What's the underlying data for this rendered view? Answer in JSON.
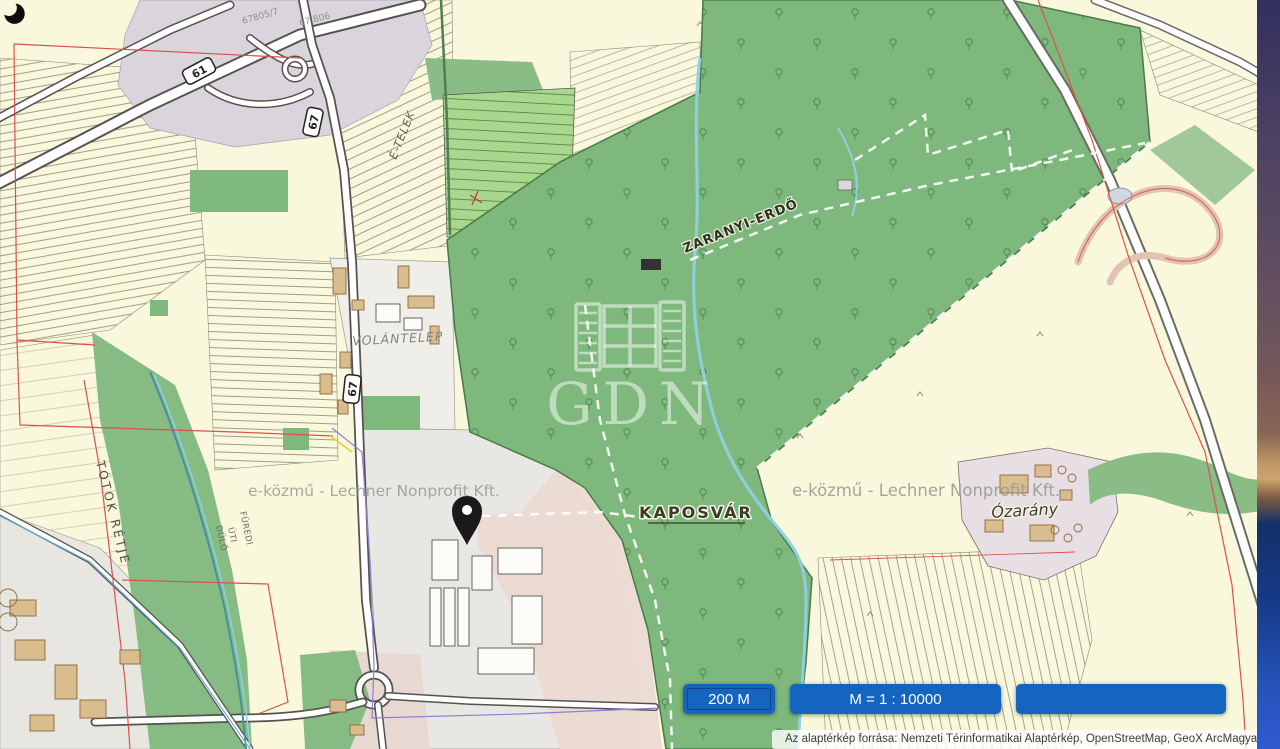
{
  "map": {
    "labels": {
      "city": "KAPOSVÁR",
      "forest": "ZARANYI-ERDŐ",
      "volantelep": "VOLÁNTELEP",
      "etelek": "É-TELEK",
      "totok_retje": "TÓTOK RÉTJE",
      "furedi": [
        "FÜREDI",
        "ÚTI",
        "DŰLŐ"
      ],
      "ozarany": "Ózarány"
    },
    "road_shields": {
      "s61": "61",
      "s67": "67"
    },
    "road_refs": {
      "ref1": "67805/7",
      "ref2": "67 806"
    },
    "watermarks": {
      "logo_text": "GDN",
      "provider": "e-közmű - Lechner Nonprofit Kft."
    }
  },
  "controls": {
    "scale_bar_label": "200 M",
    "scale_ratio_label": "M = 1 : 10000",
    "extra_label": ""
  },
  "attribution_text": "Az alaptérkép forrása: Nemzeti Térinformatikai Alaptérkép, OpenStreetMap, GeoX ArcMagyarország",
  "colors": {
    "button_blue": "#1565c0",
    "forest_green": "#7eb87c",
    "field_cream": "#f9f8dc",
    "boundary_red": "#d9534a",
    "stream_blue": "#8ed0e2"
  }
}
